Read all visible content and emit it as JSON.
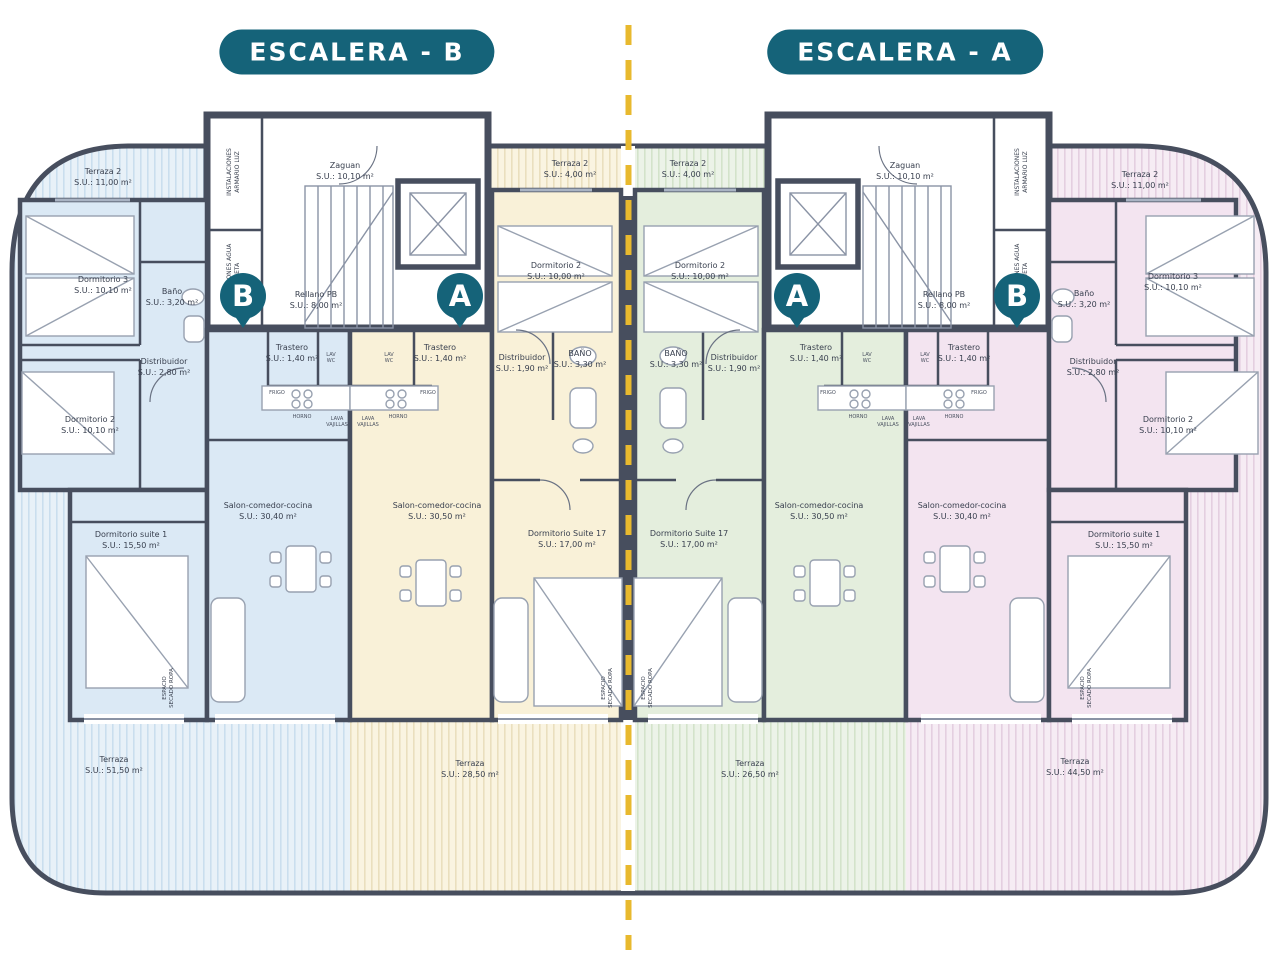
{
  "badges": {
    "left": "ESCALERA - B",
    "right": "ESCALERA - A"
  },
  "colors": {
    "teal": "#156379",
    "wall": "#474e5e",
    "dashed_axis": "#e8b92e",
    "blue_fill": "#dbe9f5",
    "yellow_fill": "#f9f1d8",
    "green_fill": "#e4eedd",
    "pink_fill": "#f3e4f0"
  },
  "cores": {
    "left": {
      "pin_left": "B",
      "pin_right": "A",
      "zaguan": {
        "name": "Zaguan",
        "area": "S.U.:  10,10 m²"
      },
      "rellano": {
        "name": "Rellano PB",
        "area": "S.U.:  8,00 m²"
      },
      "closet_luz": "INSTALACIONES ARMARIO LUZ",
      "closet_agua": "INSTALACIONES AGUA ARQUETA"
    },
    "right": {
      "pin_left": "A",
      "pin_right": "B",
      "zaguan": {
        "name": "Zaguan",
        "area": "S.U.:  10,10 m²"
      },
      "rellano": {
        "name": "Rellano PB",
        "area": "S.U.:  8,00 m²"
      },
      "closet_luz": "INSTALACIONES ARMARIO LUZ",
      "closet_agua": "INSTALACIONES AGUA ARQUETA"
    }
  },
  "apartments": {
    "blue": {
      "terraza_top": {
        "name": "Terraza 2",
        "area": "S.U.: 11,00 m²"
      },
      "dormitorio3": {
        "name": "Dormitorio 3",
        "area": "S.U.: 10,10 m²"
      },
      "bano": {
        "name": "Baño",
        "area": "S.U.: 3,20 m²"
      },
      "trastero": {
        "name": "Trastero",
        "area": "S.U.: 1,40 m²"
      },
      "distribuidor": {
        "name": "Distribuidor",
        "area": "S.U.: 2,80 m²"
      },
      "dormitorio2": {
        "name": "Dormitorio 2",
        "area": "S.U.: 10,10 m²"
      },
      "suite": {
        "name": "Dormitorio suite 1",
        "area": "S.U.: 15,50 m²"
      },
      "salon": {
        "name": "Salon-comedor-cocina",
        "area": "S.U.: 30,40 m²"
      },
      "secado": "ESPACIO SECADO ROPA",
      "terraza_bottom": {
        "name": "Terraza",
        "area": "S.U.: 51,50 m²"
      }
    },
    "yellow": {
      "terraza_top": {
        "name": "Terraza 2",
        "area": "S.U.:  4,00 m²"
      },
      "dormitorio2": {
        "name": "Dormitorio 2",
        "area": "S.U.: 10,00 m²"
      },
      "distribuidor": {
        "name": "Distribuidor",
        "area": "S.U.: 1,90 m²"
      },
      "bano": {
        "name": "BAÑO",
        "area": "S.U.: 3,30 m²"
      },
      "trastero": {
        "name": "Trastero",
        "area": "S.U.: 1,40 m²"
      },
      "suite": {
        "name": "Dormitorio Suite 17",
        "area": "S.U.: 17,00 m²"
      },
      "salon": {
        "name": "Salon-comedor-cocina",
        "area": "S.U.: 30,50 m²"
      },
      "secado": "ESPACIO SECADO ROPA",
      "terraza_bottom": {
        "name": "Terraza",
        "area": "S.U.: 28,50 m²"
      }
    },
    "green": {
      "terraza_top": {
        "name": "Terraza 2",
        "area": "S.U.:  4,00 m²"
      },
      "dormitorio2": {
        "name": "Dormitorio 2",
        "area": "S.U.: 10,00 m²"
      },
      "distribuidor": {
        "name": "Distribuidor",
        "area": "S.U.: 1,90 m²"
      },
      "bano": {
        "name": "BAÑO",
        "area": "S.U.: 3,30 m²"
      },
      "trastero": {
        "name": "Trastero",
        "area": "S.U.: 1,40 m²"
      },
      "suite": {
        "name": "Dormitorio Suite 17",
        "area": "S.U.: 17,00 m²"
      },
      "salon": {
        "name": "Salon-comedor-cocina",
        "area": "S.U.: 30,50 m²"
      },
      "secado": "ESPACIO SECADO ROPA",
      "terraza_bottom": {
        "name": "Terraza",
        "area": "S.U.: 26,50 m²"
      }
    },
    "pink": {
      "terraza_top": {
        "name": "Terraza 2",
        "area": "S.U.: 11,00 m²"
      },
      "dormitorio3": {
        "name": "Dormitorio 3",
        "area": "S.U.: 10,10 m²"
      },
      "bano": {
        "name": "Baño",
        "area": "S.U.: 3,20 m²"
      },
      "trastero": {
        "name": "Trastero",
        "area": "S.U.: 1,40 m²"
      },
      "distribuidor": {
        "name": "Distribuidor",
        "area": "S.U.: 2,80 m²"
      },
      "dormitorio2": {
        "name": "Dormitorio 2",
        "area": "S.U.: 10,10 m²"
      },
      "suite": {
        "name": "Dormitorio suite 1",
        "area": "S.U.: 15,50 m²"
      },
      "salon": {
        "name": "Salon-comedor-cocina",
        "area": "S.U.: 30,40 m²"
      },
      "secado": "ESPACIO SECADO ROPA",
      "terraza_bottom": {
        "name": "Terraza",
        "area": "S.U.: 44,50 m²"
      }
    }
  },
  "utils": {
    "lav": "LAV",
    "wc": "WC",
    "frigo": "FRIGO",
    "horno": "HORNO",
    "vitro": "VITRO",
    "lava_vajillas": "LAVA VAJILLAS"
  }
}
